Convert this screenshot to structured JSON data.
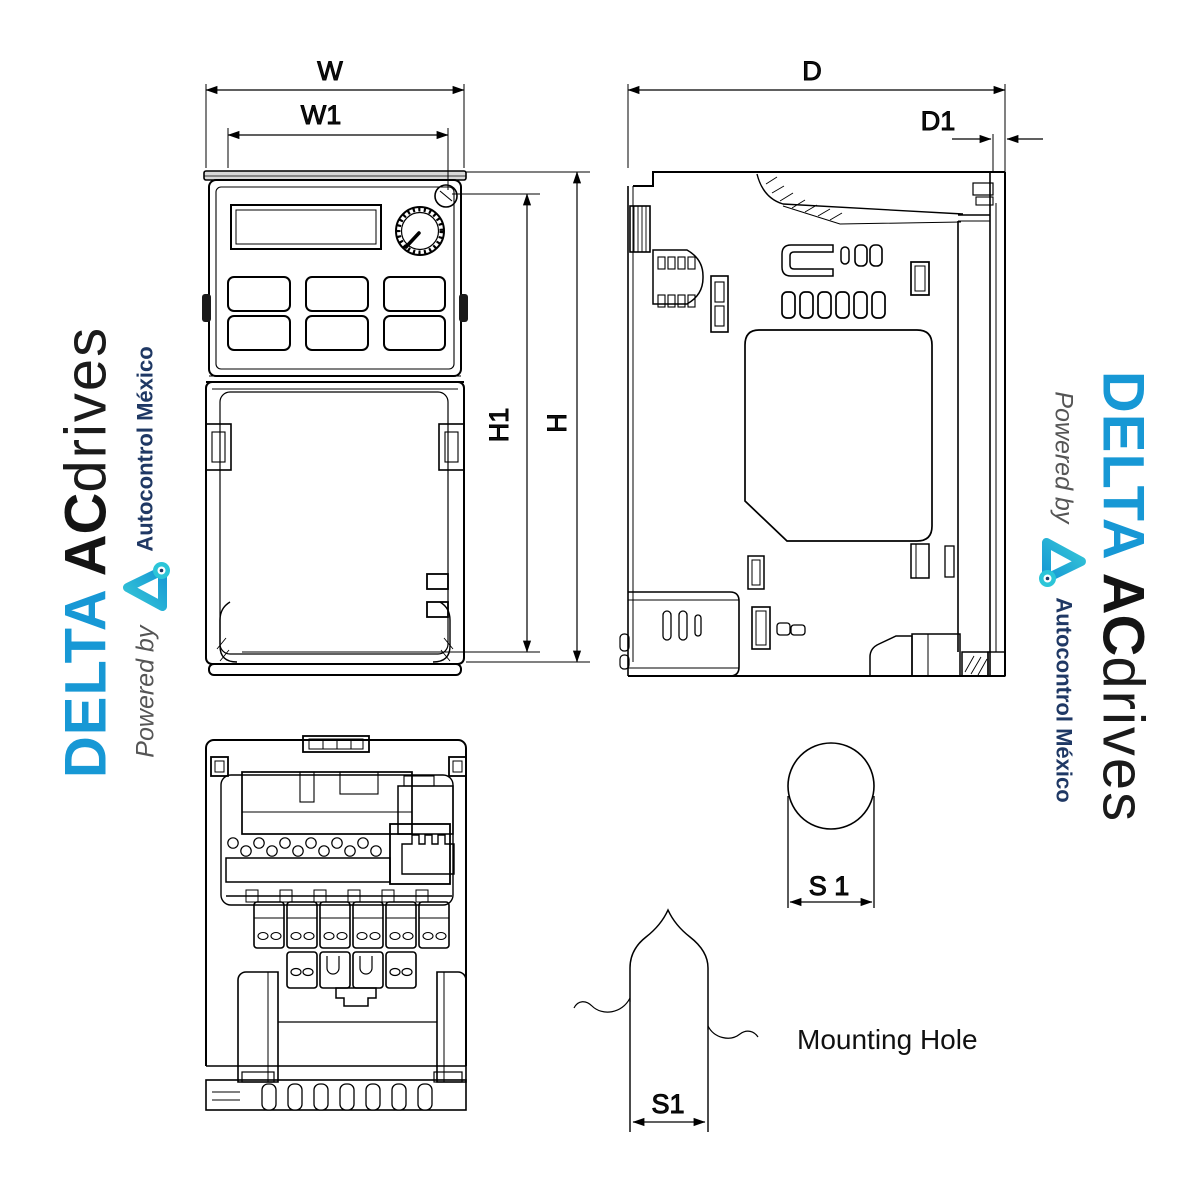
{
  "diagram": {
    "dimension_labels": {
      "width": "W",
      "width_inner": "W1",
      "height_inner": "H1",
      "height": "H",
      "depth": "D",
      "depth_plate": "D1",
      "slot_top": "S 1",
      "slot_bottom": "S1"
    },
    "caption_mounting_hole": "Mounting Hole",
    "line_color": "#000000"
  },
  "watermark": {
    "delta": "DELTA",
    "ac": "AC",
    "drives": "drives",
    "powered_by": "Powered by",
    "company": "Autocontrol México",
    "colors": {
      "delta_blue": "#1798d5",
      "logo_cyan": "#2cc5d8",
      "company_navy": "#1f3864",
      "powered_gray": "#555555"
    }
  }
}
